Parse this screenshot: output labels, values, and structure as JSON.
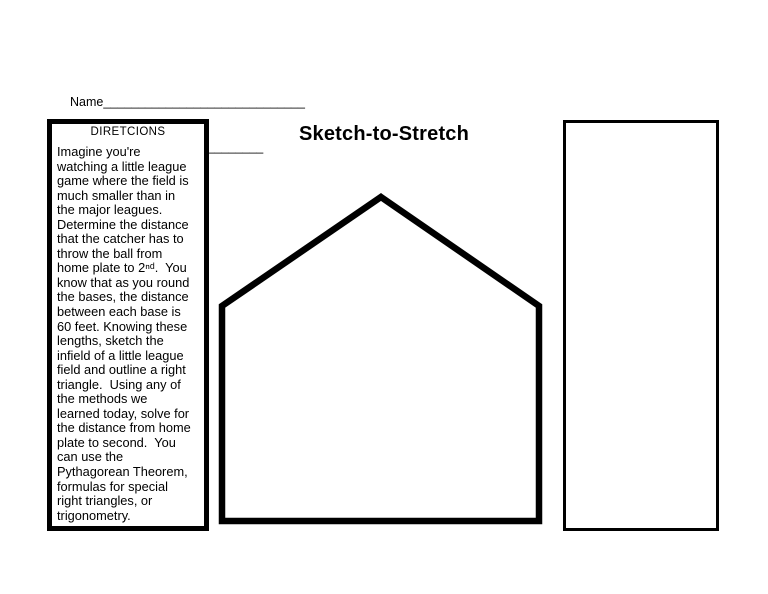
{
  "page": {
    "title": "Sketch-to-Stretch",
    "paper_color": "#ffffff",
    "ink_color": "#000000"
  },
  "header": {
    "name_label": "Name",
    "name_line": "_____________________________",
    "date_label": "Date",
    "date_line": "________________________"
  },
  "directions": {
    "heading": "DIRETCIONS",
    "lines": [
      "Imagine you're",
      "watching a little league",
      "game where the field is",
      "much smaller than in",
      "the major leagues.",
      "Determine the distance",
      "that the catcher has to",
      "throw the ball from",
      "home plate to 2ⁿᵈ.  You",
      "know that as you round",
      "the bases, the distance",
      "between each base is",
      "60 feet. Knowing these",
      "lengths, sketch the",
      "infield of a little league",
      "field and outline a right",
      "triangle.  Using any of",
      "the methods we",
      "learned today, solve for",
      "the distance from home",
      "plate to second.  You",
      "can use the",
      "Pythagorean Theorem,",
      "formulas for special",
      "right triangles, or",
      "trigonometry."
    ]
  },
  "shapes": {
    "sketch_area_shape": "home-plate-pentagon-outline",
    "answer_box_shape": "rectangle-outline"
  }
}
